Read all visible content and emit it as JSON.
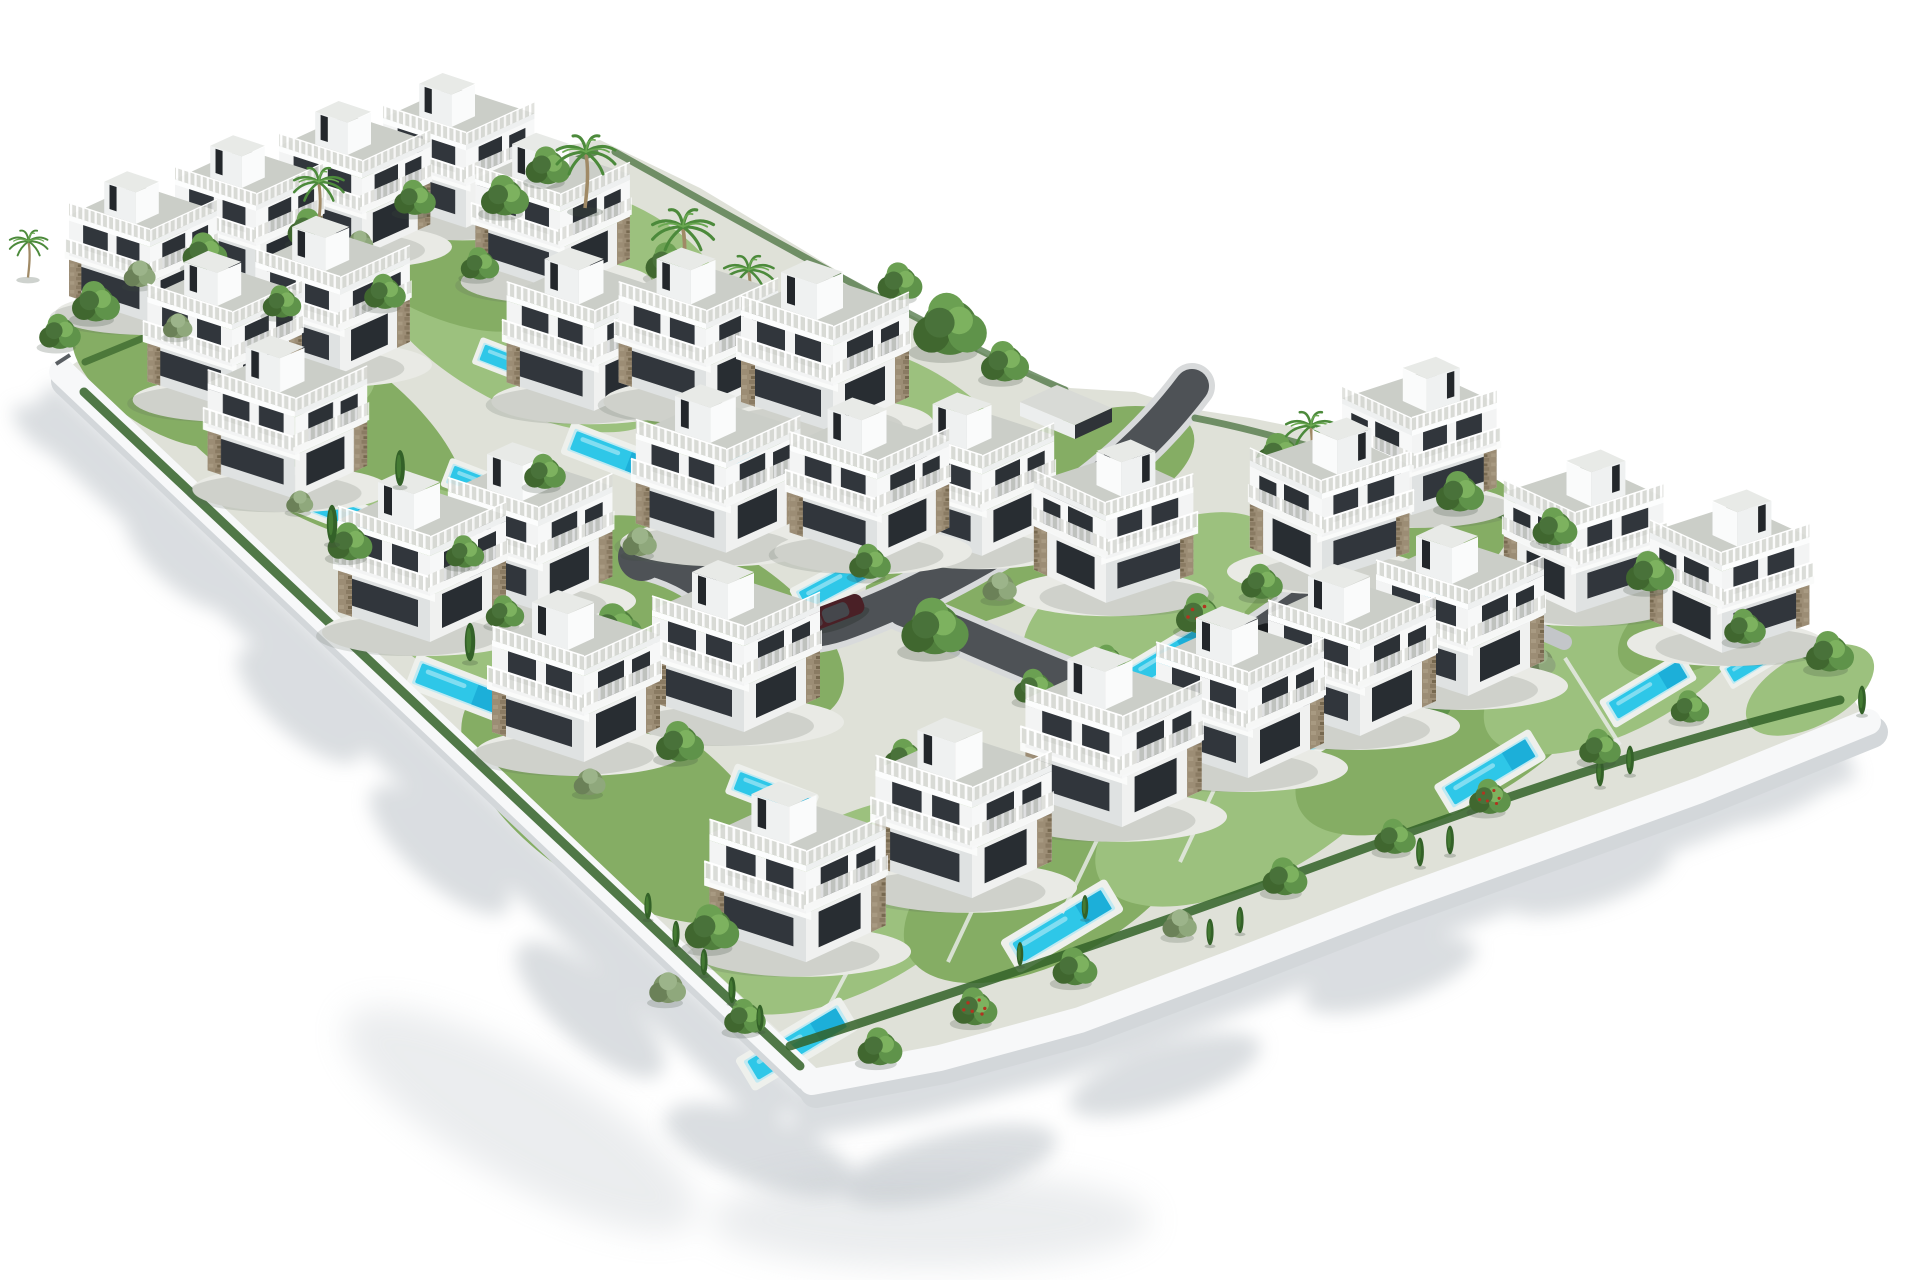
{
  "scene": {
    "description": "Aerial 3D architectural rendering of a walled residential development: rows of white modern three-storey villas with rooftop terraces and stair towers, private turquoise pools, green gardens, palm trees, hedges and curved grey internal roads with two parked cars, isolated on a white background",
    "projection": "isometric aerial view",
    "background": "#ffffff"
  },
  "colors": {
    "background": "#ffffff",
    "villa_wall": "#f3f4f4",
    "villa_wall_shaded": "#dfe2e2",
    "glass": "#31363c",
    "stone": "#9c8d75",
    "railing": "#d9dbd6",
    "roof_deck": "#cbcec8",
    "ground": "#dfe1d8",
    "grass": "#85ad64",
    "grass_light": "#9cc17e",
    "foliage": "#507f3d",
    "foliage_dark": "#3a612e",
    "foliage_light": "#6ba052",
    "olive": "#7d9468",
    "cypress": "#336128",
    "trunk": "#8a7455",
    "fruit": "#b23320",
    "pool_water": "#2ec7e8",
    "pool_deep": "#18a9d4",
    "pool_rim": "#eef0ec",
    "road": "#4e5256",
    "curb": "#d8dadb",
    "driveway": "#c3c6c9",
    "path": "#e8e9e4",
    "wall_white": "#f7f8f9",
    "wall_edge": "#d3d7da",
    "shadow": "#bcc2c8",
    "car_black": "#1b1e21",
    "car_maroon": "#4a2026"
  },
  "counts": {
    "villas": 29,
    "swimming_pools": 15,
    "cars": 2,
    "palm_trees": 7,
    "road_entrances": 1
  }
}
